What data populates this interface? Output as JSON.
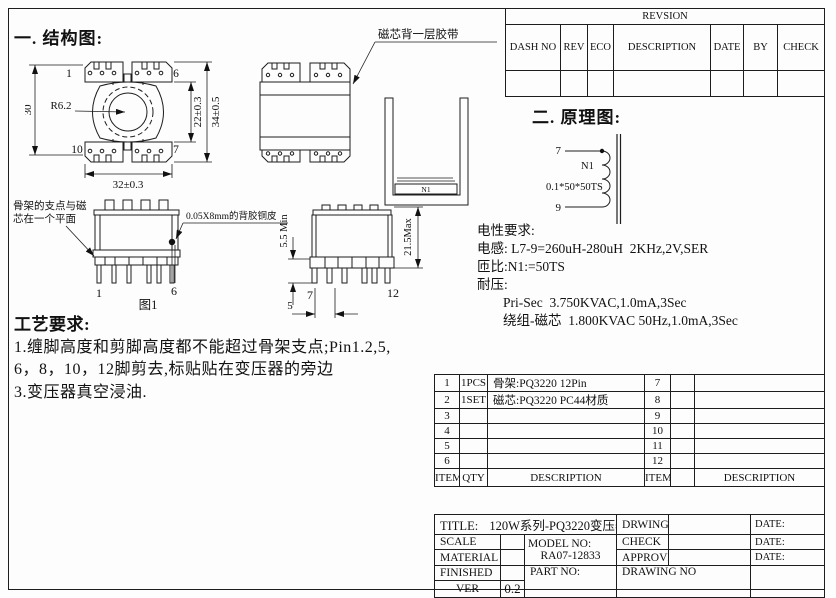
{
  "sections": {
    "structure_heading": "一. 结构图:",
    "schematic_heading": "二. 原理图:"
  },
  "revision_table": {
    "title": "REVSION",
    "columns": [
      "DASH NO",
      "REV",
      "ECO",
      "DESCRIPTION",
      "DATE",
      "BY",
      "CHECK"
    ]
  },
  "structure": {
    "top_view": {
      "pin_top_left": "1",
      "pin_top_right": "6",
      "pin_bottom_left": "10",
      "pin_bottom_right": "7",
      "dim_height": "30",
      "dim_radius": "R6.2",
      "dim_core_window": "22±0.3",
      "dim_overall_height": "34±0.5",
      "dim_width": "32±0.3"
    },
    "front_view": {
      "tape_note": "磁芯背一层胶带"
    },
    "core_view": {
      "label": "N1"
    },
    "side_view_1": {
      "caption": "图1",
      "pin_left": "1",
      "pin_right": "6",
      "note_support_line1": "骨架的支点与磁",
      "note_support_line2": "芯在一个平面",
      "note_copper_foil": "0.05X8mm的背胶铜皮"
    },
    "side_view_2": {
      "pin_left": "7",
      "pin_right": "12",
      "dim_pin_length": "5.5 Min",
      "dim_height": "21.5Max",
      "dim_pin_pitch": "5"
    }
  },
  "schematic": {
    "pin_top": "7",
    "pin_bottom": "9",
    "winding_label": "N1",
    "wire_spec": "0.1*50*50TS"
  },
  "electrical": {
    "title": "电性要求:",
    "inductance": "电感: L7-9=260uH-280uH  2KHz,2V,SER",
    "turns_ratio": "匝比:N1:=50TS",
    "hipot_title": "耐压:",
    "hipot_pri_sec": "Pri-Sec  3.750KVAC,1.0mA,3Sec",
    "hipot_winding_core": "绕组-磁芯  1.800KVAC 50Hz,1.0mA,3Sec"
  },
  "process": {
    "title": "工艺要求:",
    "line1": "1.缠脚高度和剪脚高度都不能超过骨架支点;Pin1.2,5,",
    "line2": "6，8，10，12脚剪去,标贴贴在变压器的旁边",
    "line3": "3.变压器真空浸油."
  },
  "bom": {
    "rows": [
      [
        "1",
        "1PCS",
        "骨架:PQ3220 12Pin",
        "7",
        "",
        ""
      ],
      [
        "2",
        "1SET",
        "磁芯:PQ3220 PC44材质",
        "8",
        "",
        ""
      ],
      [
        "3",
        "",
        "",
        "9",
        "",
        ""
      ],
      [
        "4",
        "",
        "",
        "10",
        "",
        ""
      ],
      [
        "5",
        "",
        "",
        "11",
        "",
        ""
      ],
      [
        "6",
        "",
        "",
        "12",
        "",
        ""
      ]
    ],
    "footer": [
      "ITEM",
      "QTY",
      "DESCRIPTION",
      "ITEM",
      "",
      "DESCRIPTION"
    ]
  },
  "title_block": {
    "title_label": "TITLE:",
    "title_value": "120W系列-PQ3220变压器",
    "drwing_label": "DRWING",
    "check_label": "CHECK",
    "approve_label": "APPROVE",
    "drawing_no_label": "DRAWING NO",
    "date_label_1": "DATE:",
    "date_label_2": "DATE:",
    "date_label_3": "DATE:",
    "scale_label": "SCALE",
    "material_label": "MATERIAL",
    "finished_label": "FINISHED",
    "ver_label": "VER",
    "ver_value": "0.2",
    "model_no_label": "MODEL NO:",
    "model_no_value": "RA07-12833",
    "part_no_label": "PART NO:"
  }
}
